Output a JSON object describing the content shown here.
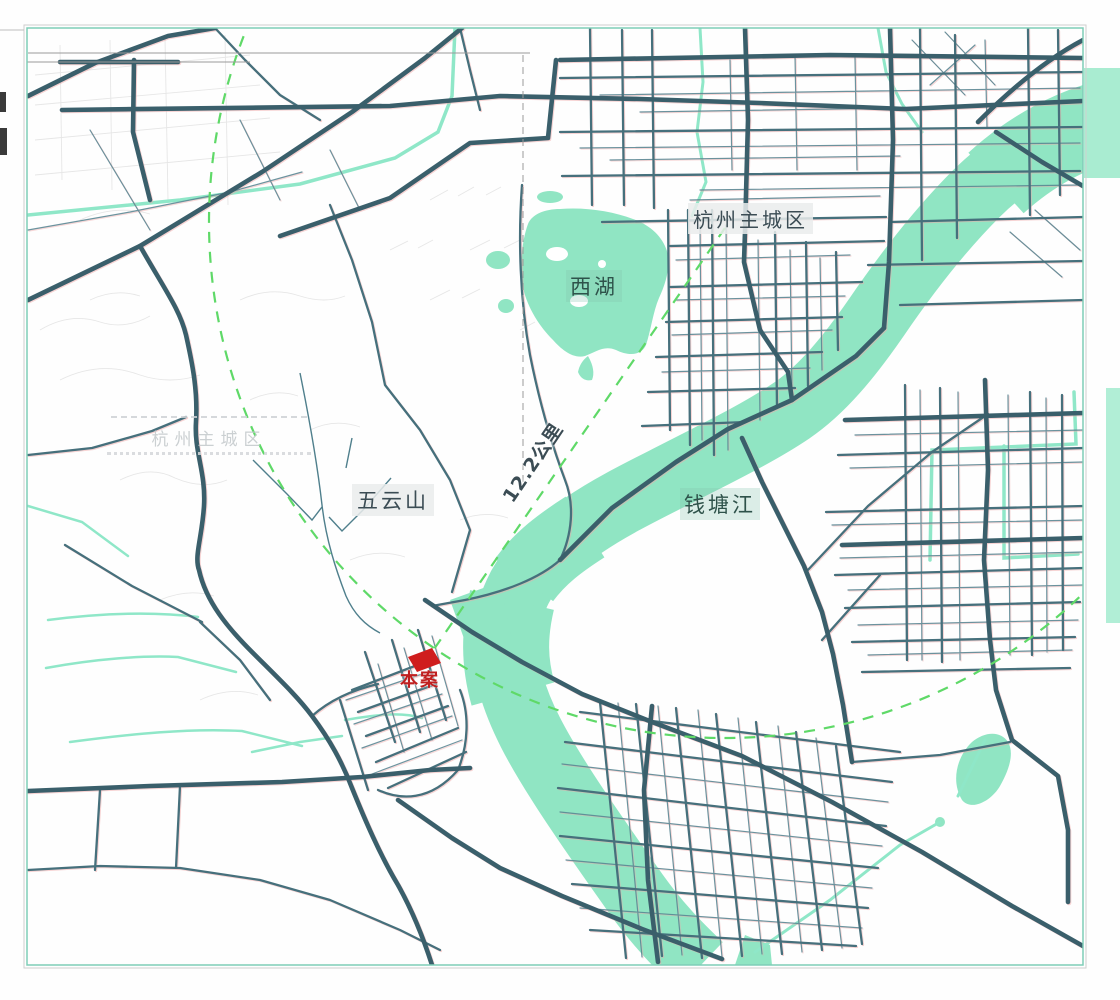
{
  "map": {
    "title_context": "site location map",
    "labels": {
      "city": "杭州主城区",
      "west_lake": "西湖",
      "wuyun_mountain": "五云山",
      "qiantang_river": "钱塘江",
      "distance": "12.2公里",
      "site": "本案",
      "ghost_city": "杭州主城区"
    },
    "colors": {
      "water_fill": "#90e5c3",
      "canal_line": "#8fe7c8",
      "road_major": "#3a5f6b",
      "road_medium": "#46707c",
      "road_minor": "#5b8793",
      "dashed_green": "#5fd968",
      "site_red": "#cf1d1d",
      "label_text": "#3b4c54",
      "frame_teal": "#7fcdb7",
      "leader_gray": "#9a9a9a"
    }
  }
}
